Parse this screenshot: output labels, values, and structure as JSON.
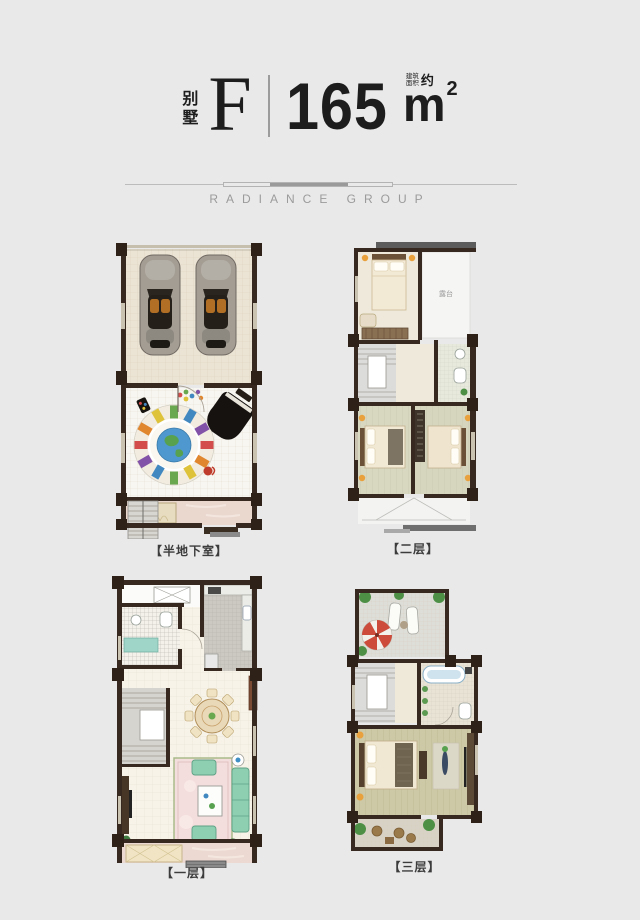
{
  "header": {
    "villa_label": "别墅",
    "unit_type": "F",
    "area_value": "165",
    "area_note_top": "建筑",
    "area_note_bottom": "面积",
    "area_note_approx": "约",
    "area_unit": "m",
    "area_unit_sup": "2"
  },
  "brand": {
    "name": "RADIANCE GROUP"
  },
  "plans": {
    "basement": {
      "label": "【半地下室】"
    },
    "floor2": {
      "label": "【二层】",
      "terrace_label": "露台"
    },
    "floor1": {
      "label": "【一层】"
    },
    "floor3": {
      "label": "【三层】"
    }
  },
  "palette": {
    "background": "#e9e9e9",
    "text_dark": "#1d1d1d",
    "brand_gray": "#9b9b9b",
    "wall": "#37291f",
    "garage_floor": "#ebe3d4",
    "tile_floor": "#f8f6f0",
    "sage_floor": "#d8d7c0",
    "wood_floor": "#cdc8a5",
    "marble_pink": "#ead8cf",
    "kitchen_gray": "#ccc9c3",
    "terrace_gray": "#deded8",
    "stairs_gray": "#d8d6d1",
    "car_gray": "#a39d94",
    "piano_black": "#161210",
    "sofa_green": "#8ecfb2",
    "rug_pink": "#f3dedd",
    "rug_world_blue": "#4f98cf",
    "umbrella_red": "#cc4b3a",
    "lamp_orange": "#e8a13c",
    "plant_green": "#4e8f46"
  }
}
